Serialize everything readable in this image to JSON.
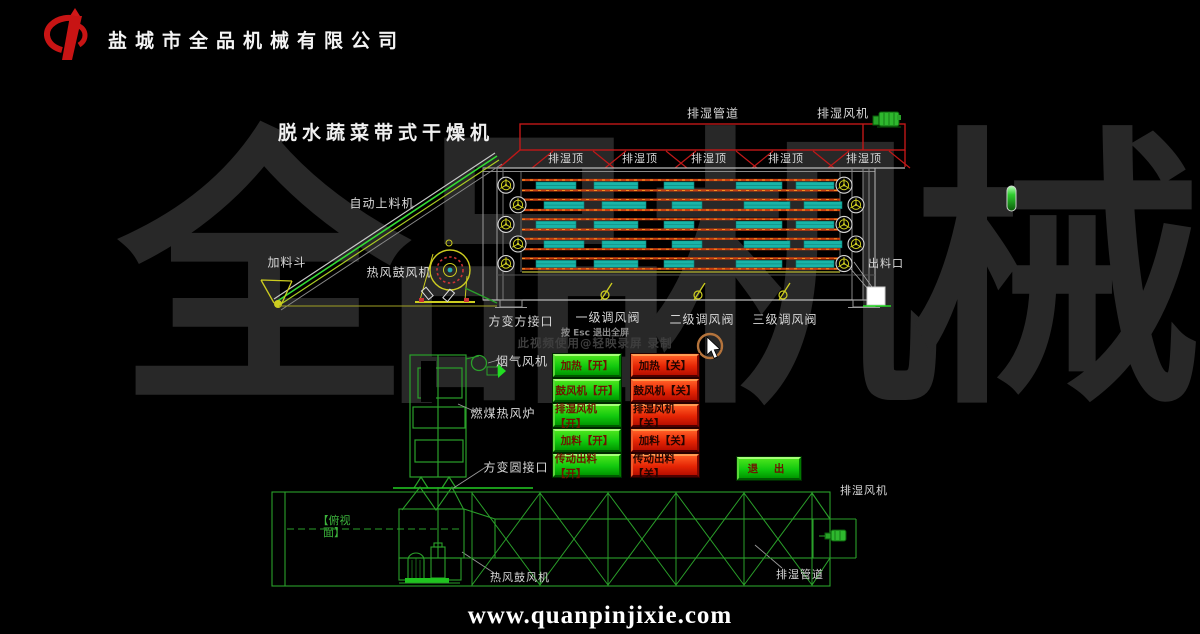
{
  "header": {
    "company_name": "盐城市全品机械有限公司"
  },
  "title": "脱水蔬菜带式干燥机",
  "side_view": {
    "duct_label": "排湿管道",
    "fan_label": "排湿风机",
    "vent_labels": [
      "排湿顶",
      "排湿顶",
      "排湿顶",
      "排湿顶",
      "排湿顶"
    ],
    "feeder_label": "自动上料机",
    "hopper_label": "加料斗",
    "blower_label": "热风鼓风机",
    "outlet_label": "出料口",
    "square_joint_label": "方变方接口",
    "damper_labels": [
      "一级调风阀",
      "二级调风阀",
      "三级调风阀"
    ]
  },
  "furnace": {
    "flue_fan_label": "烟气风机",
    "furnace_label": "燃煤热风炉",
    "round_joint_label": "方变圆接口"
  },
  "top_view": {
    "view_label": "【俯视\n面】",
    "blower_label": "热风鼓风机",
    "duct_label": "排湿管道",
    "fan_label": "排湿风机"
  },
  "overlay": {
    "esc_hint": "按 Esc 退出全屏",
    "recorder_credit": "此视频使用@轻映录屏 录制"
  },
  "control_panel": {
    "on_buttons": [
      "加热【开】",
      "鼓风机【开】",
      "排湿风机【开】",
      "加料【开】",
      "传动出料【开】"
    ],
    "off_buttons": [
      "加热【关】",
      "鼓风机【关】",
      "排湿风机【关】",
      "加料【关】",
      "传动出料【关】"
    ],
    "exit_label": "退 出"
  },
  "footer": {
    "website": "www.quanpinjixie.com"
  },
  "watermark": "全品机械",
  "colors": {
    "cad_green": "#2aa02a",
    "cad_red": "#c01818",
    "belt_orange": "#c84010",
    "belt_teal": "#19b5a8",
    "button_green": "#11c80e",
    "button_red": "#e42404",
    "logo_red": "#cc1414"
  }
}
